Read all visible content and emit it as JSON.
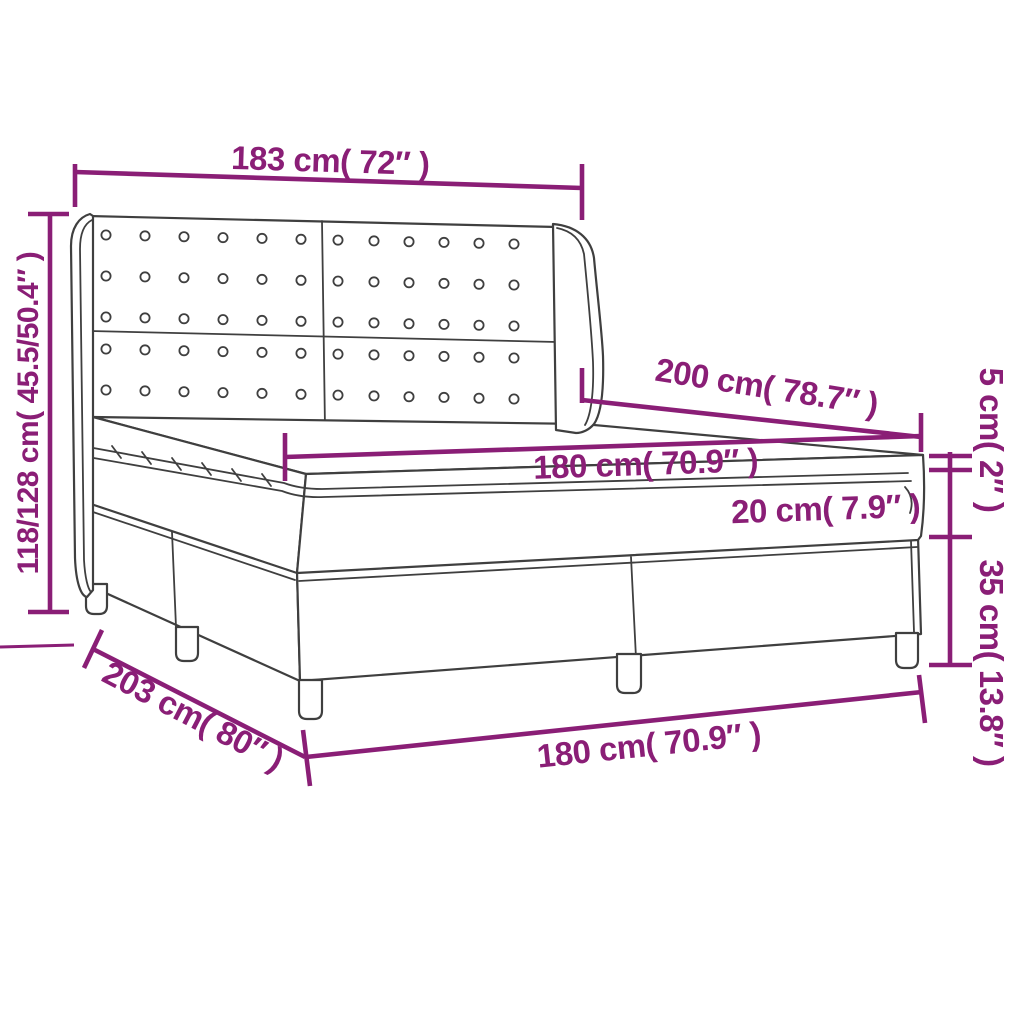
{
  "diagram": {
    "subject": "box spring bed with winged tufted headboard, mattress and topper",
    "colors": {
      "dimension_annotation": "#8A1E76",
      "drawing_outline": "#3F3F3F",
      "background": "#FFFFFF"
    },
    "headboard": {
      "panels": 2,
      "button_rows": 5,
      "button_cols_per_panel": 6
    },
    "dimensions": {
      "headboard_width": "183 cm( 72″ )",
      "total_height": "118/128 cm( 45.5/50.4″ )",
      "bed_length": "200 cm( 78.7″ )",
      "mattress_width": "180 cm( 70.9″ )",
      "mattress_height": "20 cm( 7.9″ )",
      "topper_height": "5 cm( 2″ )",
      "base_height": "35 cm( 13.8″ )",
      "base_width": "180 cm( 70.9″ )",
      "base_length": "203 cm( 80″ )"
    }
  }
}
